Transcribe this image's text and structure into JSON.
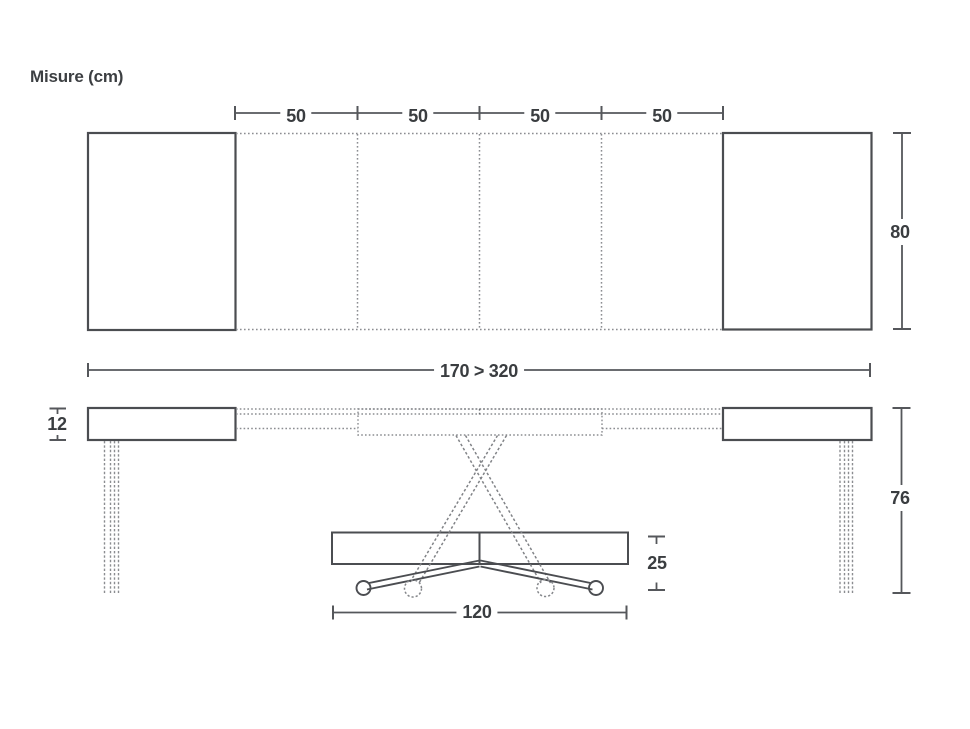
{
  "title": "Misure (cm)",
  "top_view": {
    "extension_labels": [
      "50",
      "50",
      "50",
      "50"
    ],
    "depth": "80",
    "width_range": "170 > 320"
  },
  "side_view": {
    "top_thickness": "12",
    "height": "76",
    "base_height": "25",
    "base_width": "120"
  },
  "colors": {
    "solid_line": "#4b4d51",
    "dimension_line": "#55575b",
    "dotted_line": "#8b8d91",
    "text": "#3a3d40",
    "background": "#ffffff"
  }
}
